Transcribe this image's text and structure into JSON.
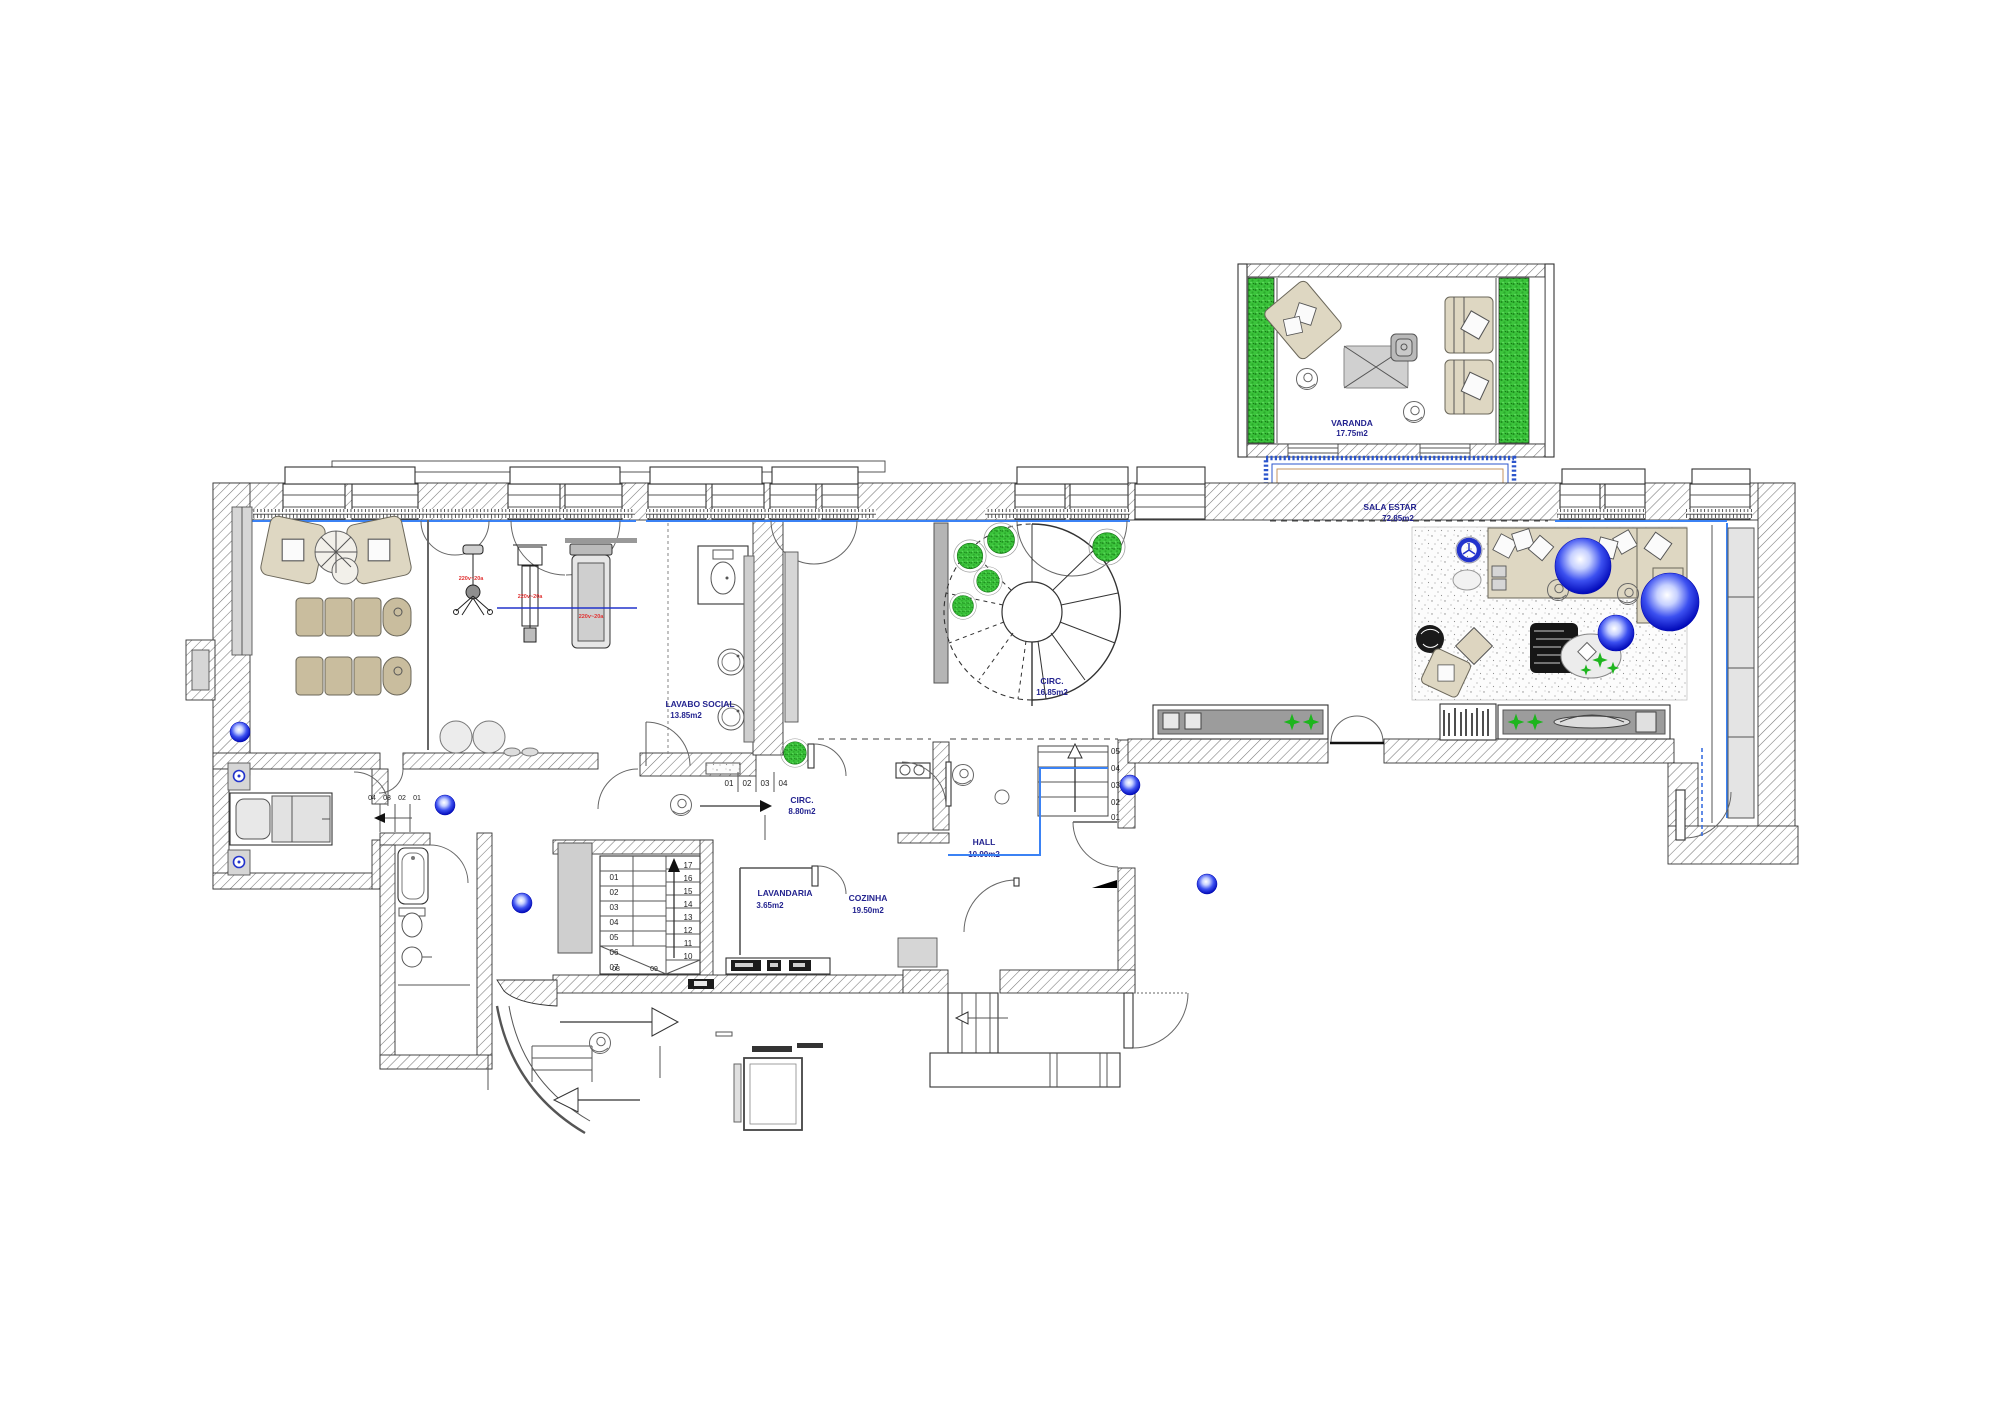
{
  "colors": {
    "label_navy": "#23238f",
    "power_red": "#e03232",
    "plant_green": "#1db51d",
    "sphere_blue": "#2a3cdc",
    "floor_line_blue": "#3b82f4",
    "wall_hatch": "#555555",
    "furniture_beige": "#ded7c2",
    "furniture_tan": "#c9bd9e"
  },
  "rooms": {
    "varanda": {
      "name": "VARANDA",
      "area": "17.75m2"
    },
    "sala_estar": {
      "name": "SALA ESTAR",
      "area": "72.85m2"
    },
    "circ_spiral": {
      "name": "CIRC.",
      "area": "16.85m2"
    },
    "circ_small": {
      "name": "CIRC.",
      "area": "8.80m2"
    },
    "lavabo_social": {
      "name": "LAVABO SOCIAL",
      "area": "13.85m2"
    },
    "hall": {
      "name": "HALL",
      "area": "10.90m2"
    },
    "lavandaria": {
      "name": "LAVANDARIA",
      "area": "3.65m2"
    },
    "cozinha": {
      "name": "COZINHA",
      "area": "19.50m2"
    }
  },
  "equipment": {
    "bike_power": "220v~20a",
    "multigym_power": "220v~20a",
    "treadmill_power": "220v~20a"
  },
  "stairs": {
    "main_left": [
      "01",
      "02",
      "03",
      "04",
      "05",
      "06",
      "07"
    ],
    "main_right": [
      "17",
      "16",
      "15",
      "14",
      "13",
      "12",
      "11",
      "10"
    ],
    "main_winders": [
      "08",
      "09"
    ],
    "lavabo_steps": [
      "01",
      "02",
      "03",
      "04"
    ],
    "hall_steps": [
      "05",
      "04",
      "03",
      "02",
      "01"
    ],
    "bedroom_steps": [
      "04",
      "03",
      "02",
      "01"
    ]
  }
}
